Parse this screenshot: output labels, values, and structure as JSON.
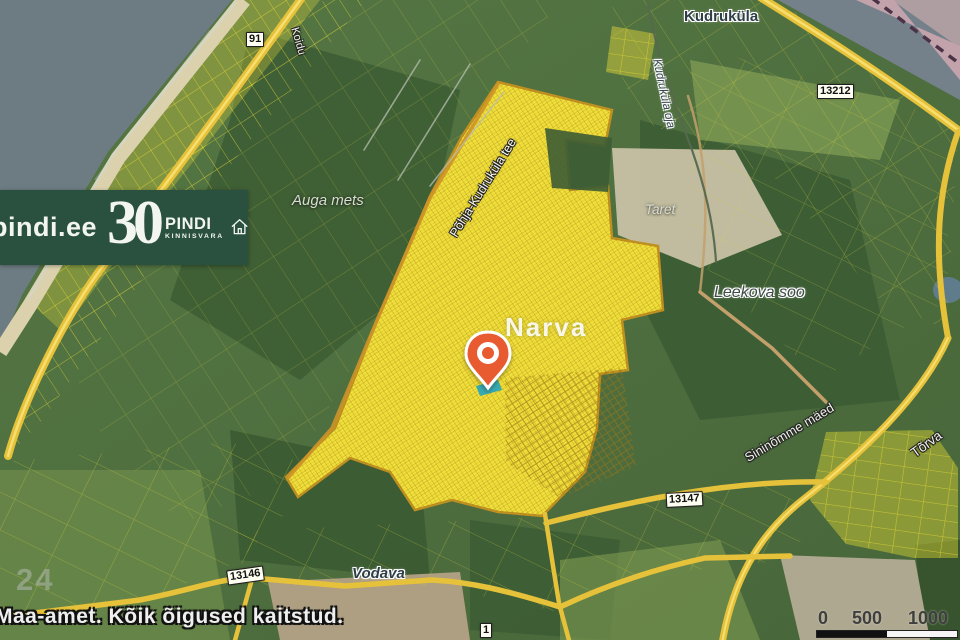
{
  "watermark": {
    "site": "pindi.ee",
    "anniversary_number": "30",
    "brand": "PINDI",
    "brand_subtitle": "KINNISVARA",
    "background_color": "#2a5140"
  },
  "map": {
    "city_label": "Narva",
    "place_labels": {
      "kudrukula": "Kudruküla",
      "vodava": "Vodava"
    },
    "nature_labels": {
      "auga_mets": "Auga mets",
      "taret": "Taret",
      "leekova_soo": "Leekova soo",
      "kudrukula_oja": "Kudruküla oja",
      "sininomme_maed": "Sininõmme mäed",
      "torva": "Tõrva"
    },
    "street_labels": {
      "pohja_kudrukula_tee": "Põhja-Kudruküla tee",
      "koidu": "Koidu"
    },
    "parcel_ghost_number": "24",
    "road_badges": {
      "b91": "91",
      "b13212": "13212",
      "b13146": "13146",
      "b13147": "13147",
      "b1": "1"
    },
    "marker": {
      "shape": "pin",
      "color": "#e85a2f",
      "highlight_parcel_color": "#2ea8b6"
    },
    "scale_bar": {
      "tick0": "0",
      "tick500": "500",
      "tick1000": "1000"
    },
    "copyright": "Maa-amet. Kõik õigused kaitstud."
  }
}
